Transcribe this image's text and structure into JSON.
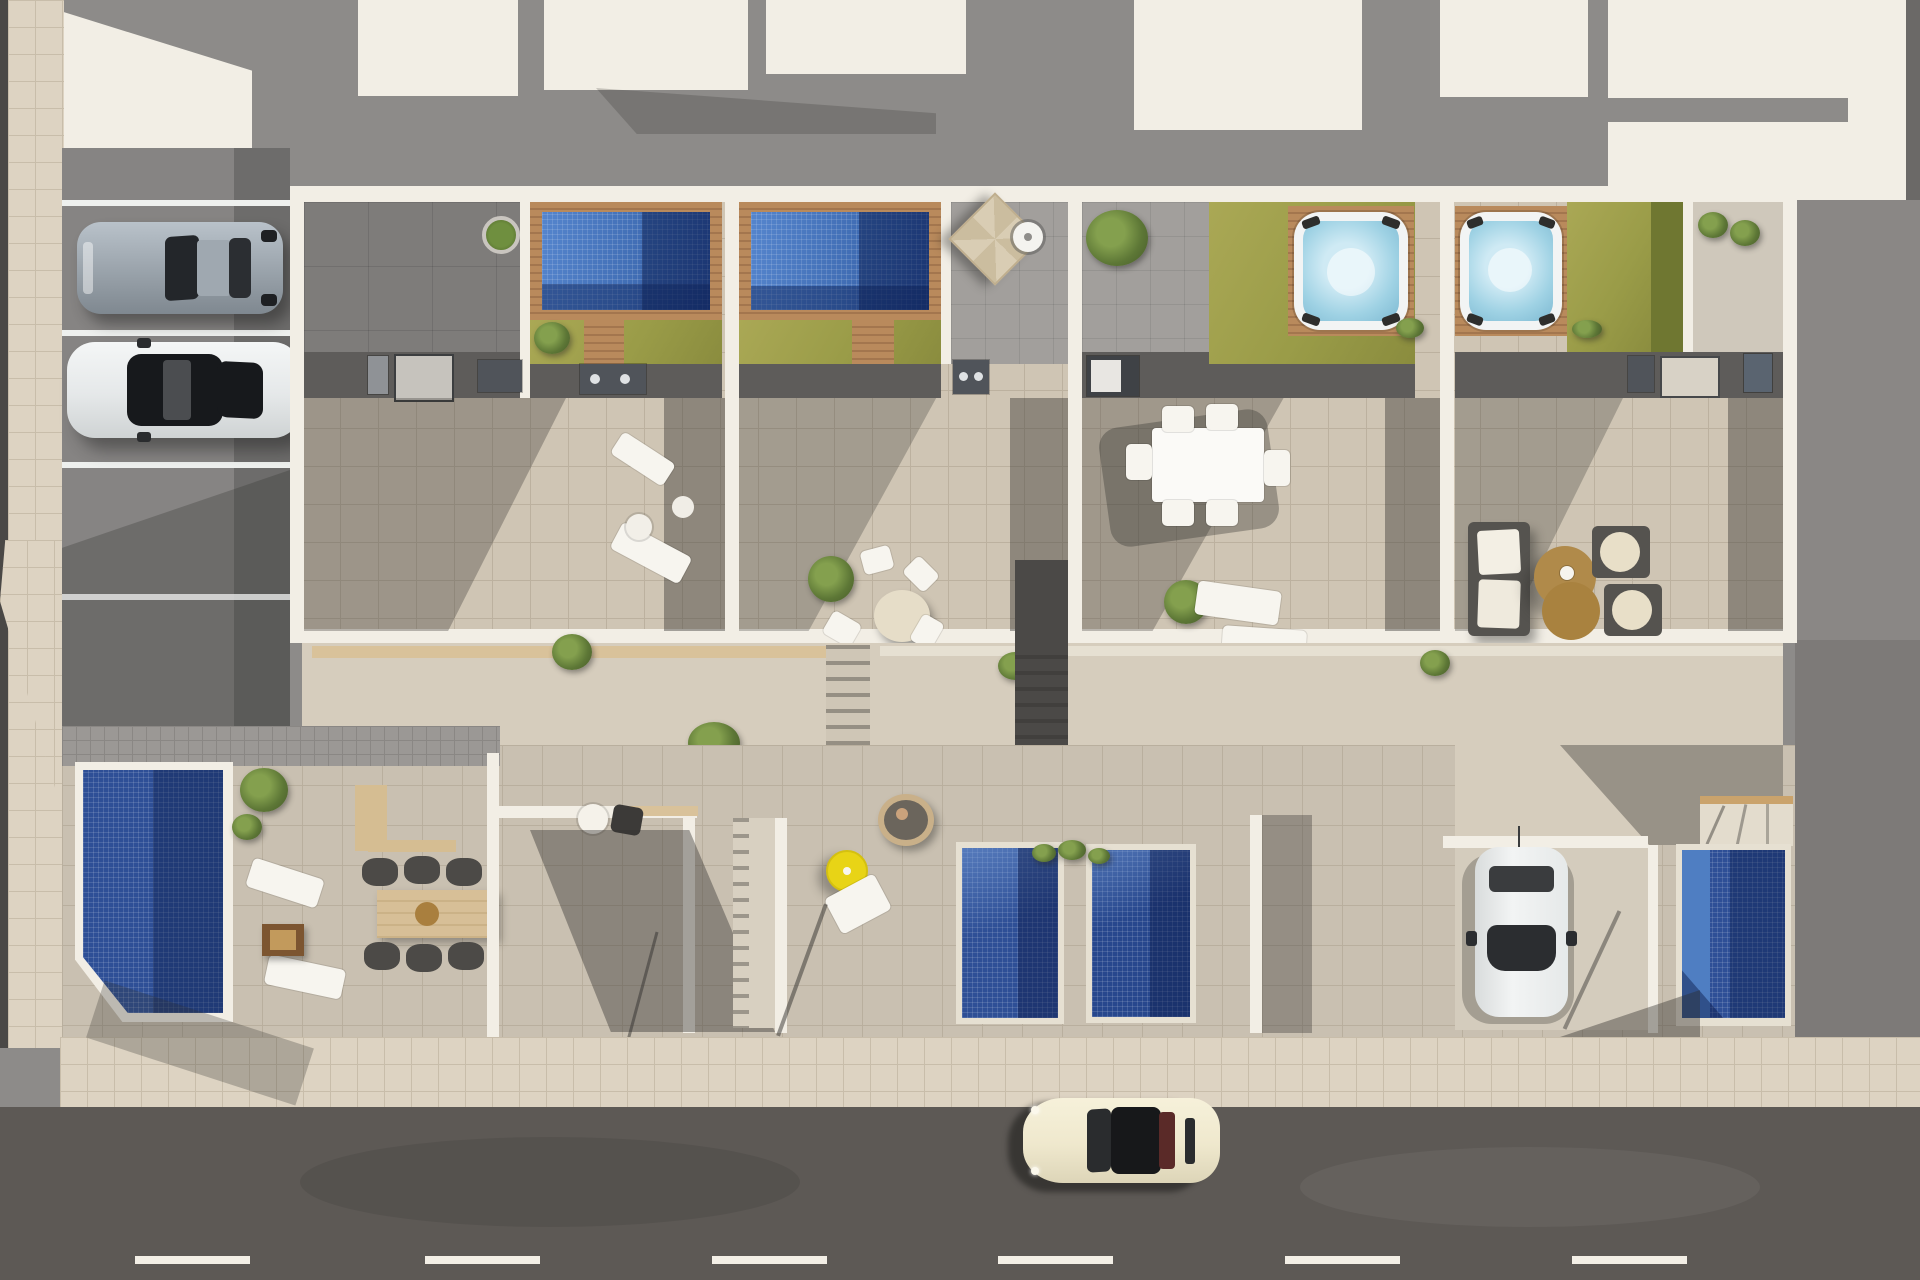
{
  "scene": {
    "type": "aerial-architectural-render",
    "description": "Top-down 3D render of a row of four modern townhouses: rooftop terraces with mosaic plunge pools, jacuzzis and lawns, ground-floor patios with pools, a private driveway, guest parking and a street with a passing car",
    "palette": {
      "roof_gray": "#8d8b89",
      "roof_dark": "#757371",
      "wall_cream": "#f2eee5",
      "parking_gray": "#868483",
      "paver_beige": "#cfc5b4",
      "patio_beige": "#c9c0b1",
      "sidewalk": "#ddd3c2",
      "road": "#5d5955",
      "road_dash": "#f3efe6",
      "pool_light": "#4d80c8",
      "pool_mid": "#2e4f96",
      "pool_navy": "#1d3a78",
      "jacuzzi_water": "#aad9ea",
      "deck_wood": "#b98a5c",
      "lawn_bright": "#a3a14e",
      "lawn_olive": "#6f7731",
      "parasol_yellow": "#e8d416",
      "parasol_beige": "#d9cdb4",
      "timber_table": "#d7bf97",
      "coffee_table": "#b08a4a",
      "car_silver": "#9fa8b0",
      "car_white": "#eceef0",
      "car_cream": "#efe8cd"
    },
    "objects": {
      "rooftop_pools": 2,
      "jacuzzis": 2,
      "ground_pools": 4,
      "parking_cars": [
        {
          "color_name": "silver-blue coupe"
        },
        {
          "color_name": "white sedan"
        }
      ],
      "driveway_car": {
        "color_name": "white hatchback"
      },
      "street_car": {
        "color_name": "cream classic coupe",
        "heading": "west"
      },
      "furniture": [
        "2 rooftop sun loungers with side table (unit 1)",
        "oval dining table with 4 chairs (unit 2)",
        "rectangular dining table with 6 chairs (unit 3)",
        "2 sun loungers (unit 3)",
        "sofa, 2 armchairs and twin round coffee tables (unit 4)",
        "timber dining table with 6 wicker chairs and fire table (ground unit A)",
        "2 ground-floor sun loungers (ground unit A)",
        "bistro table and chair (ground unit B)",
        "yellow parasol with lounger and hanging egg chair (ground unit C)"
      ],
      "parasols": [
        {
          "color": "beige"
        },
        {
          "color": "yellow"
        }
      ],
      "lane_dashes": 6,
      "parking_line_count": 4
    }
  }
}
